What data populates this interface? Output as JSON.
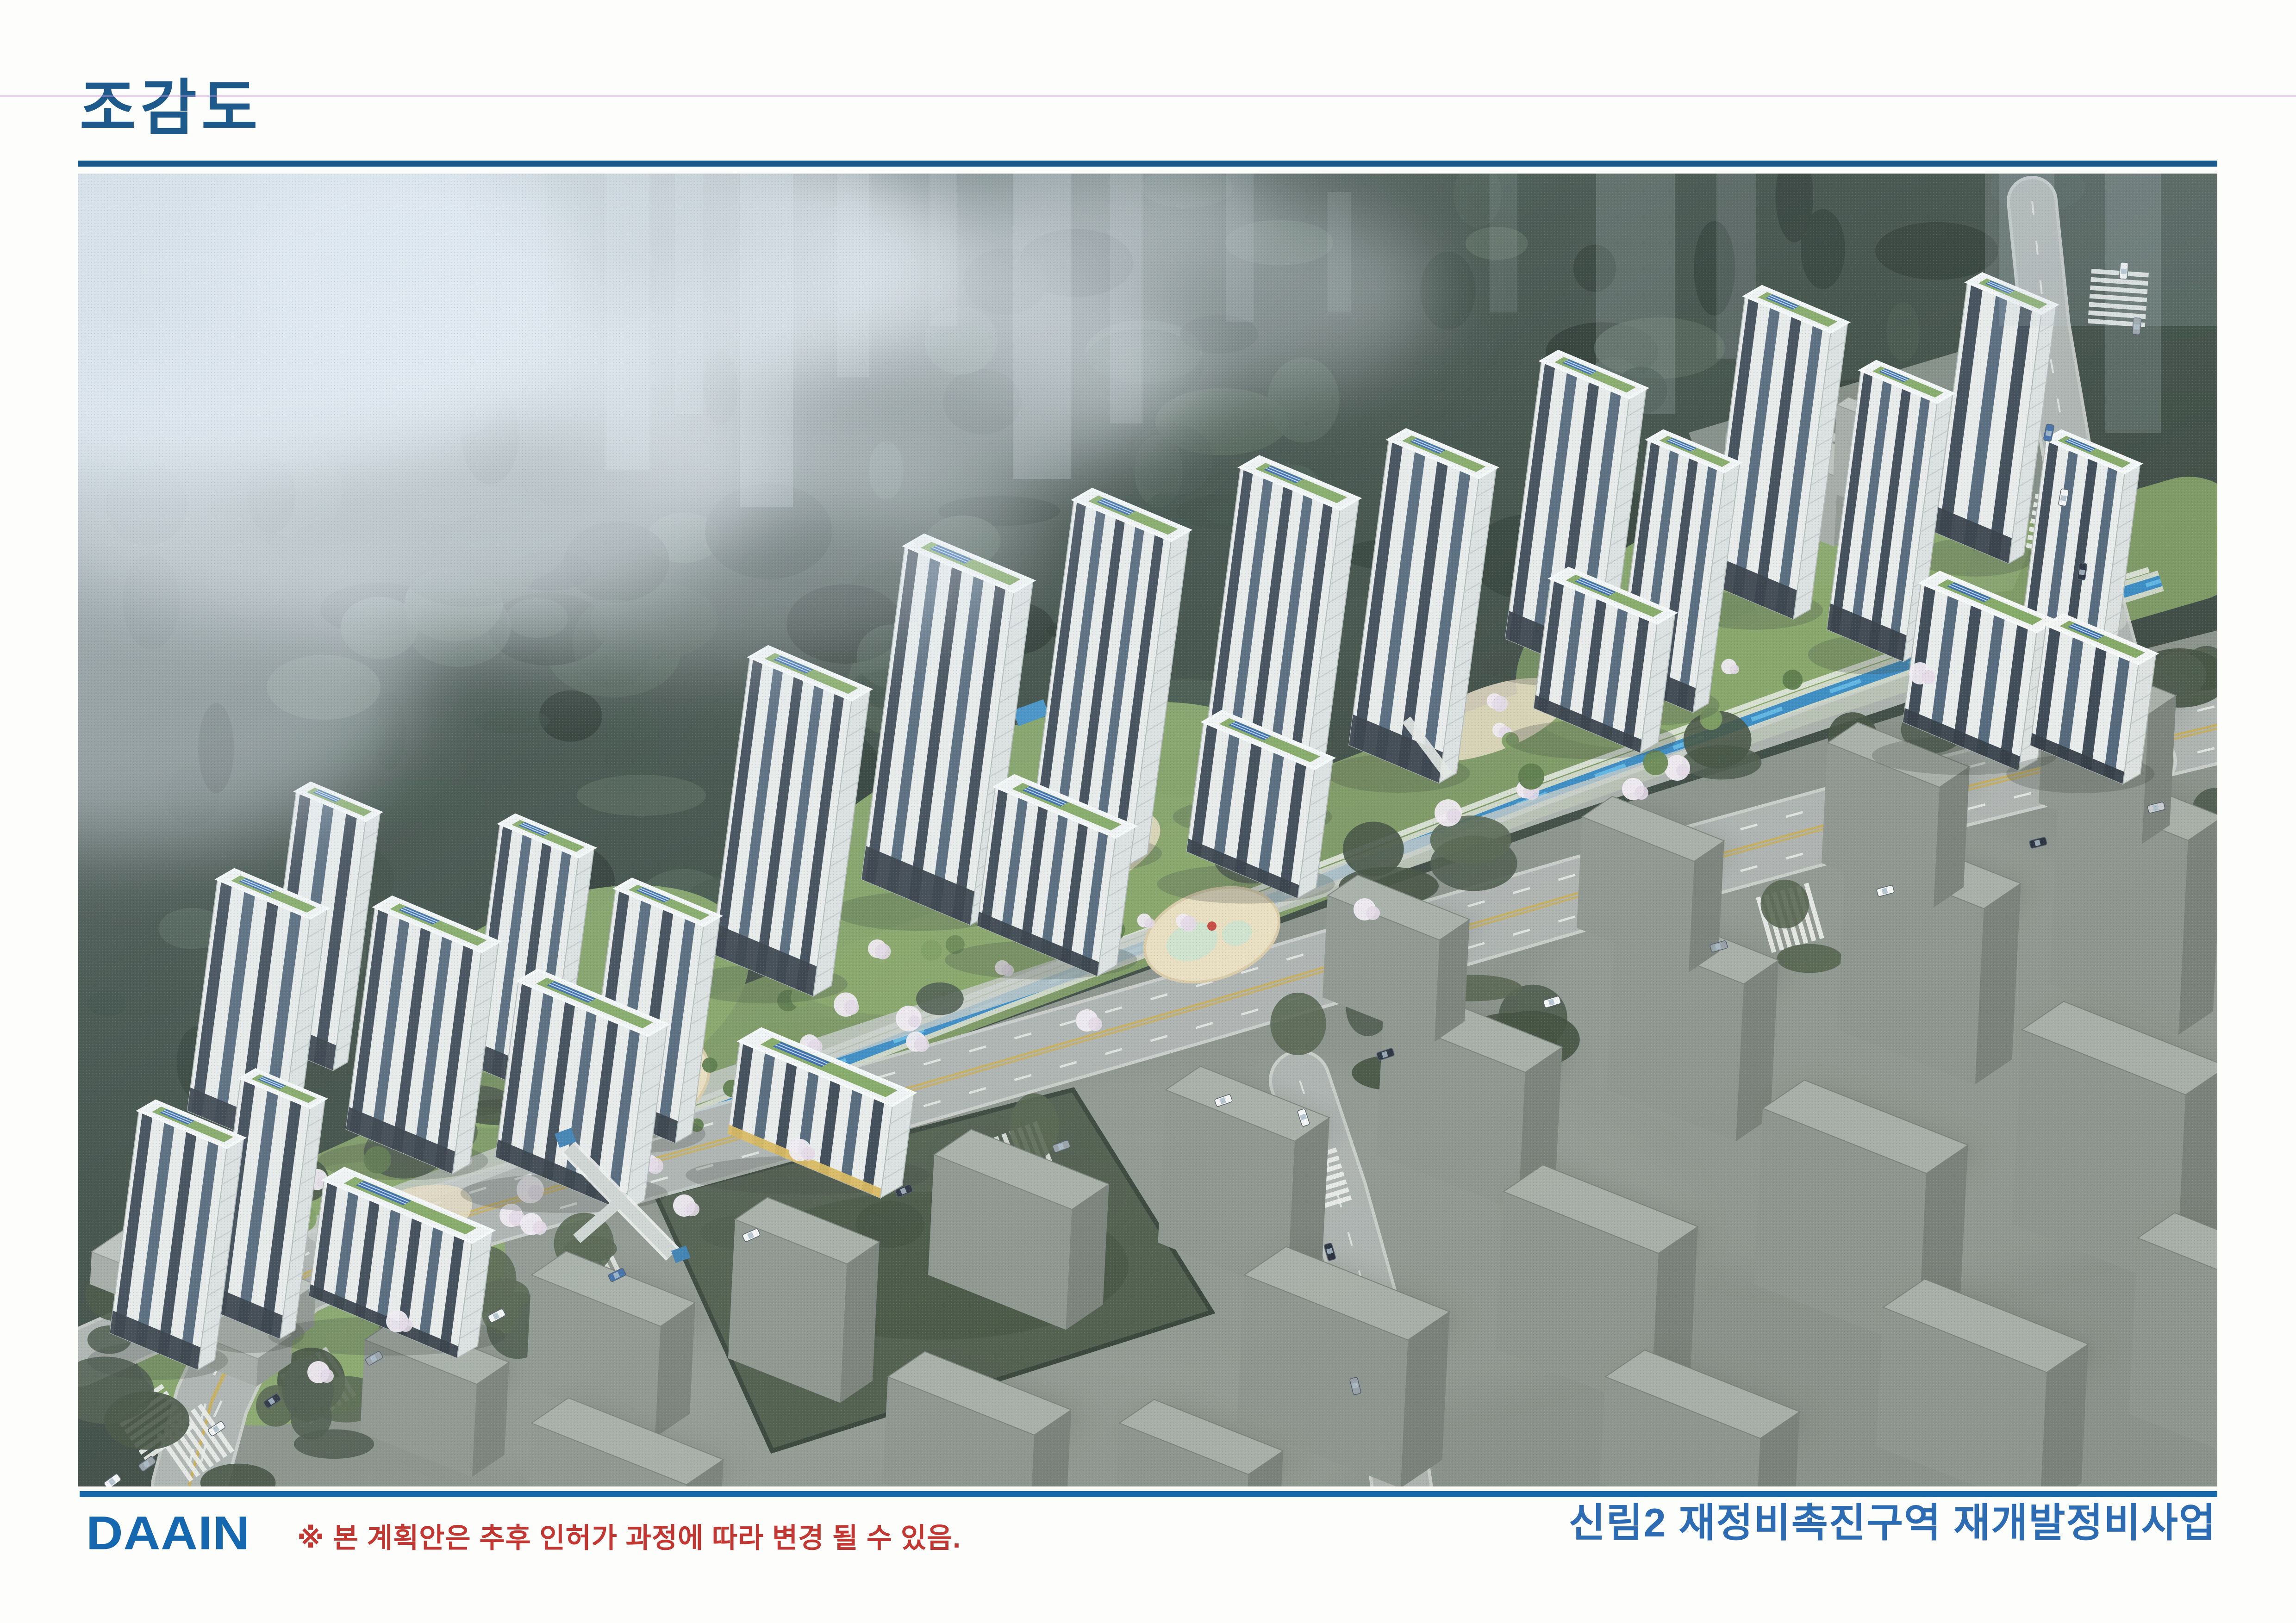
{
  "header": {
    "title": "조감도"
  },
  "footer": {
    "logo_text": "DAAIN",
    "disclaimer": "※ 본 계획안은 추후 인허가 과정에 따라 변경 될 수 있음.",
    "project_name": "신림2 재정비촉진구역 재개발정비사업"
  },
  "colors": {
    "title_blue": "#1d598a",
    "rule_blue": "#1a598c",
    "footer_rule_blue": "#1668aa",
    "logo_blue": "#1568b0",
    "disclaimer_red": "#c33732",
    "project_blue": "#2d6cb2",
    "forest_green": "#3c4a42",
    "urban_gray": "#8f968f",
    "road_gray": "#aeb3b0",
    "stream_blue": "#2f86c2",
    "solar_blue": "#3568a8",
    "roof_green": "#7ca45b"
  },
  "rendering": {
    "alt": "Aerial bird's-eye rendering of the Sillim2 redevelopment apartment complex: white high-rise towers with green roofs and solar panels along a forested hillside, a blue stream, landscaped courtyards with cherry blossoms, and surrounding gray city blocks with roads",
    "towers": [
      [
        132,
        2025,
        190,
        480,
        70
      ],
      [
        352,
        1955,
        150,
        500,
        62
      ],
      [
        532,
        2175,
        320,
        250,
        85
      ],
      [
        302,
        1525,
        200,
        500,
        70
      ],
      [
        472,
        1335,
        150,
        540,
        60
      ],
      [
        642,
        1585,
        230,
        480,
        72
      ],
      [
        912,
        1405,
        170,
        520,
        64
      ],
      [
        952,
        1745,
        280,
        380,
        80
      ],
      [
        1162,
        1545,
        190,
        470,
        68
      ],
      [
        1430,
        1875,
        330,
        200,
        90
      ],
      [
        1452,
        1045,
        220,
        640,
        76
      ],
      [
        1787,
        805,
        235,
        720,
        80
      ],
      [
        2152,
        705,
        210,
        700,
        76
      ],
      [
        2512,
        635,
        215,
        690,
        78
      ],
      [
        2832,
        575,
        195,
        660,
        72
      ],
      [
        1982,
        1325,
        260,
        300,
        80
      ],
      [
        2432,
        1185,
        240,
        280,
        76
      ],
      [
        3162,
        405,
        190,
        600,
        70
      ],
      [
        3392,
        575,
        165,
        520,
        64
      ],
      [
        3602,
        265,
        185,
        620,
        70
      ],
      [
        3852,
        425,
        165,
        560,
        64
      ],
      [
        4082,
        235,
        160,
        540,
        62
      ],
      [
        4252,
        575,
        170,
        480,
        64
      ],
      [
        3982,
        885,
        250,
        300,
        78
      ],
      [
        4252,
        975,
        200,
        260,
        72
      ],
      [
        3182,
        875,
        230,
        280,
        74
      ]
    ],
    "blocks": [
      [
        620,
        2520,
        260,
        140,
        200
      ],
      [
        980,
        2380,
        300,
        150,
        240
      ],
      [
        1420,
        2260,
        260,
        140,
        300
      ],
      [
        1850,
        2120,
        320,
        160,
        260
      ],
      [
        2350,
        1980,
        300,
        150,
        330
      ],
      [
        2820,
        1820,
        330,
        160,
        300
      ],
      [
        3320,
        1640,
        300,
        150,
        340
      ],
      [
        3820,
        1470,
        320,
        160,
        380
      ],
      [
        4280,
        1330,
        300,
        150,
        420
      ],
      [
        980,
        2700,
        360,
        160,
        130
      ],
      [
        2520,
        2380,
        380,
        180,
        320
      ],
      [
        3080,
        2200,
        360,
        170,
        340
      ],
      [
        3640,
        2020,
        380,
        180,
        380
      ],
      [
        4200,
        1850,
        380,
        180,
        420
      ],
      [
        1750,
        2600,
        340,
        160,
        230
      ],
      [
        2250,
        2700,
        300,
        150,
        130
      ],
      [
        3300,
        2600,
        360,
        170,
        230
      ],
      [
        3900,
        2450,
        380,
        180,
        300
      ],
      [
        4450,
        2300,
        280,
        160,
        380
      ],
      [
        2700,
        1560,
        260,
        130,
        220
      ],
      [
        3250,
        1390,
        260,
        130,
        240
      ],
      [
        3780,
        1230,
        260,
        130,
        260
      ],
      [
        4250,
        1080,
        240,
        120,
        280
      ]
    ],
    "cars": [
      [
        300,
        2712,
        -34,
        0
      ],
      [
        420,
        2652,
        -33,
        1
      ],
      [
        640,
        2560,
        -30,
        2
      ],
      [
        905,
        2468,
        -28,
        0
      ],
      [
        1165,
        2380,
        -26,
        3
      ],
      [
        1455,
        2294,
        -24,
        0
      ],
      [
        1785,
        2198,
        -22,
        1
      ],
      [
        2125,
        2102,
        -20,
        2
      ],
      [
        2475,
        2003,
        -19,
        0
      ],
      [
        2825,
        1903,
        -18,
        1
      ],
      [
        3185,
        1790,
        -17,
        0
      ],
      [
        3545,
        1670,
        -16,
        2
      ],
      [
        3905,
        1550,
        -15,
        0
      ],
      [
        4235,
        1446,
        -14,
        1
      ],
      [
        4490,
        1370,
        -14,
        4
      ],
      [
        2648,
        2040,
        72,
        0
      ],
      [
        2705,
        2330,
        74,
        1
      ],
      [
        2760,
        2620,
        76,
        2
      ],
      [
        4258,
        560,
        -78,
        3
      ],
      [
        4290,
        700,
        -80,
        0
      ],
      [
        4330,
        860,
        -82,
        1
      ],
      [
        4420,
        210,
        -86,
        0
      ],
      [
        4448,
        330,
        -86,
        2
      ],
      [
        150,
        2788,
        -36,
        2
      ],
      [
        75,
        2826,
        -36,
        0
      ]
    ],
    "crosswalks": [
      [
        520,
        2618,
        -32
      ],
      [
        760,
        2520,
        -29
      ],
      [
        1120,
        2395,
        -26
      ],
      [
        2040,
        2126,
        -21
      ],
      [
        2900,
        1880,
        -18
      ],
      [
        3700,
        1608,
        -16
      ],
      [
        4420,
        1392,
        -14
      ],
      [
        2676,
        2180,
        73
      ],
      [
        255,
        2742,
        -35
      ],
      [
        165,
        2700,
        55
      ],
      [
        4280,
        760,
        -80
      ],
      [
        4408,
        268,
        -86
      ]
    ],
    "ghost_towers": [
      [
        1140,
        0,
        95,
        640,
        0.3
      ],
      [
        1290,
        0,
        60,
        520,
        0.22
      ],
      [
        1430,
        0,
        115,
        720,
        0.3
      ],
      [
        1640,
        0,
        70,
        440,
        0.22
      ],
      [
        1840,
        0,
        60,
        330,
        0.18
      ],
      [
        2020,
        0,
        125,
        660,
        0.28
      ],
      [
        2230,
        0,
        70,
        540,
        0.2
      ],
      [
        2480,
        0,
        60,
        320,
        0.16
      ],
      [
        3280,
        0,
        170,
        520,
        0.22
      ],
      [
        3540,
        0,
        85,
        400,
        0.18
      ],
      [
        4120,
        0,
        150,
        420,
        0.2
      ],
      [
        4380,
        0,
        120,
        560,
        0.22
      ],
      [
        760,
        0,
        80,
        380,
        0.18
      ],
      [
        950,
        0,
        60,
        300,
        0.14
      ],
      [
        2700,
        40,
        50,
        260,
        0.14
      ],
      [
        3050,
        0,
        60,
        300,
        0.14
      ]
    ],
    "fog": [
      [
        260,
        260,
        860,
        430,
        0.92
      ],
      [
        1080,
        190,
        800,
        330,
        0.78
      ],
      [
        640,
        640,
        860,
        340,
        0.55
      ],
      [
        1700,
        430,
        720,
        290,
        0.45
      ],
      [
        2300,
        260,
        640,
        240,
        0.36
      ],
      [
        120,
        1060,
        620,
        390,
        0.42
      ],
      [
        1300,
        790,
        780,
        270,
        0.32
      ],
      [
        2050,
        80,
        500,
        180,
        0.3
      ]
    ]
  }
}
